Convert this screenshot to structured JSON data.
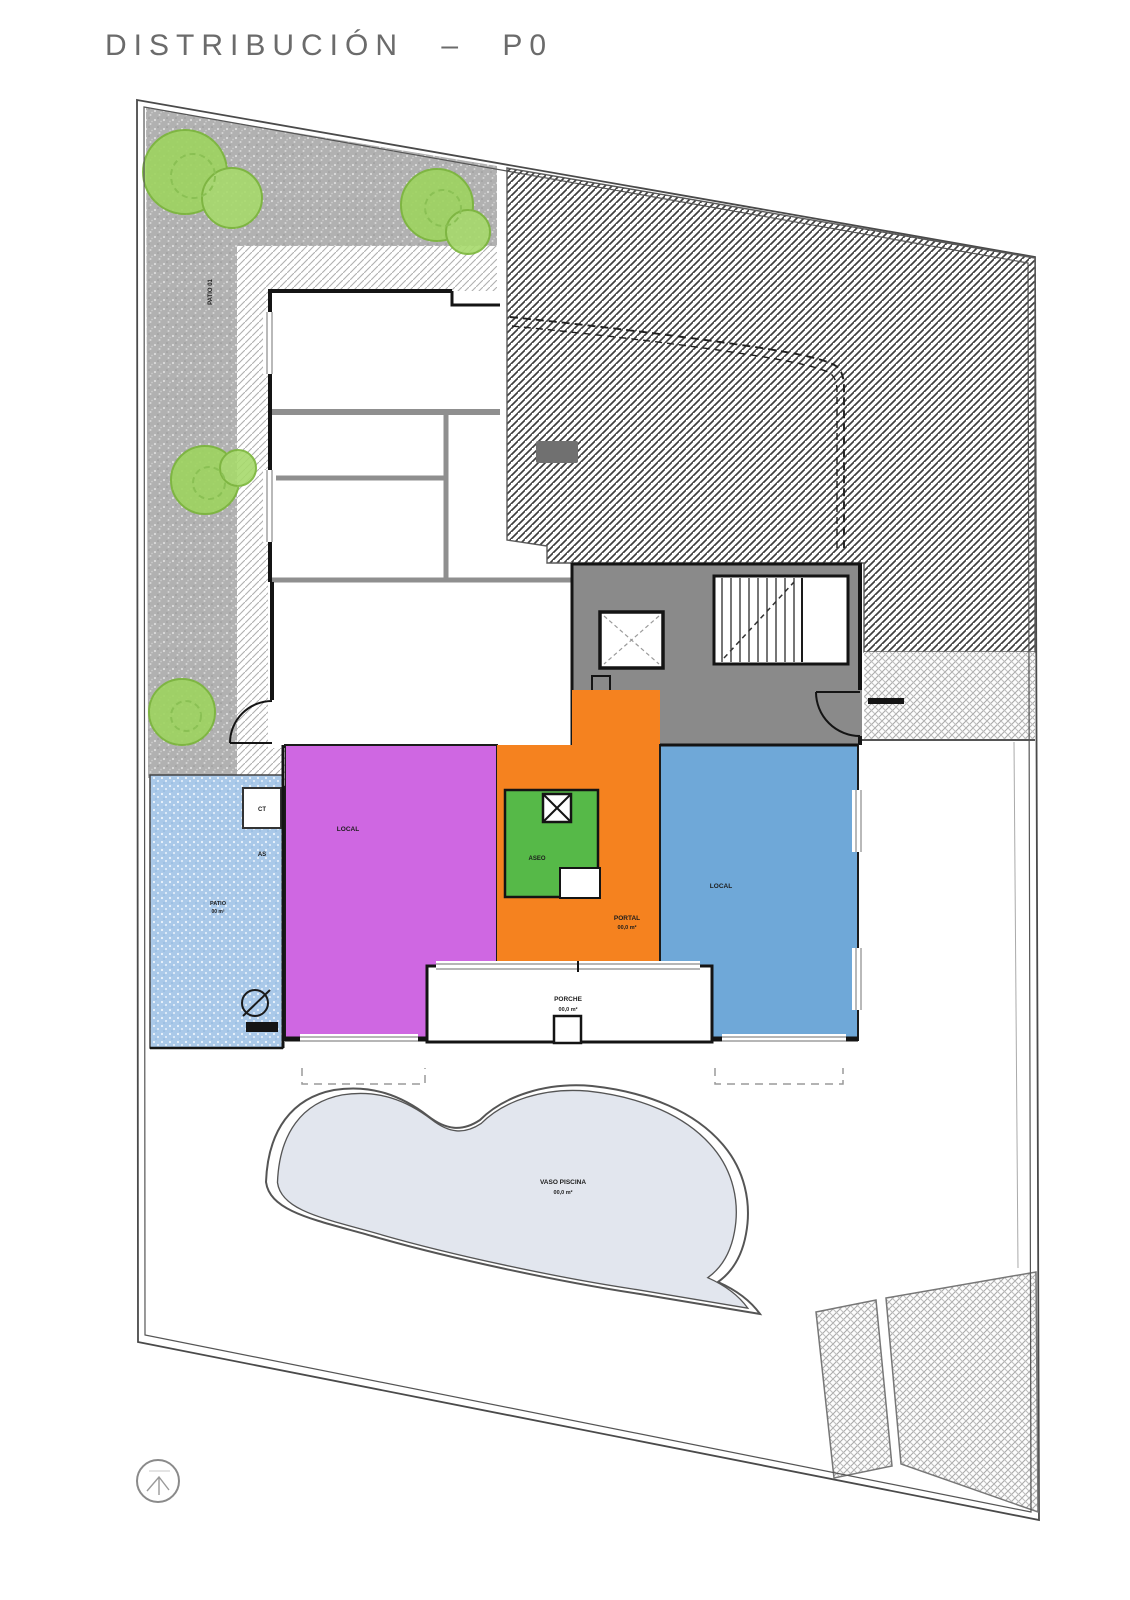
{
  "header": {
    "title": "DISTRIBUCIÓN  –  P0"
  },
  "palette": {
    "room_magenta": "#cf67e2",
    "room_orange": "#f5821f",
    "room_green": "#56b948",
    "room_blue": "#6fa8d8",
    "patio_blue": "#aac9e9",
    "garden_gray": "#b1b1b1",
    "core_gray": "#8a8a8a",
    "pool_fill": "#e2e6ee",
    "tree_green": "#9ed45f",
    "wall_black": "#141414"
  },
  "rooms": {
    "local_left": {
      "label": "LOCAL"
    },
    "portal": {
      "label": "PORTAL",
      "area": "00,0 m²"
    },
    "aseo": {
      "label": "ASEO"
    },
    "local_right": {
      "label": "LOCAL"
    },
    "patio_lateral": {
      "label": "PATIO",
      "area": "00 m²"
    },
    "porche": {
      "label": "PORCHE",
      "area": "00,0 m²"
    },
    "piscina": {
      "label": "VASO PISCINA",
      "area": "00,0 m²"
    },
    "patio_jardin": {
      "label": "PATIO 01"
    },
    "cuarto_ct": {
      "label": "CT"
    },
    "cuarto_as": {
      "label": "AS"
    }
  },
  "icons": {
    "north": "north-arrow-circle"
  }
}
